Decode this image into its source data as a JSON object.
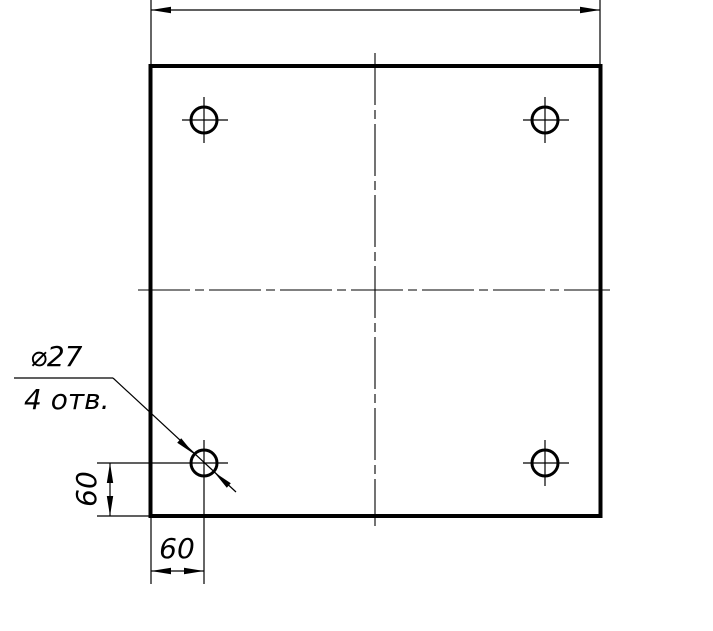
{
  "drawing": {
    "callout": {
      "diameter_label": "⌀27",
      "holes_count_label": "4 отв."
    },
    "dimensions": {
      "left_offset": "60",
      "bottom_offset": "60"
    },
    "colors": {
      "line": "#000000",
      "background": "#ffffff"
    }
  }
}
